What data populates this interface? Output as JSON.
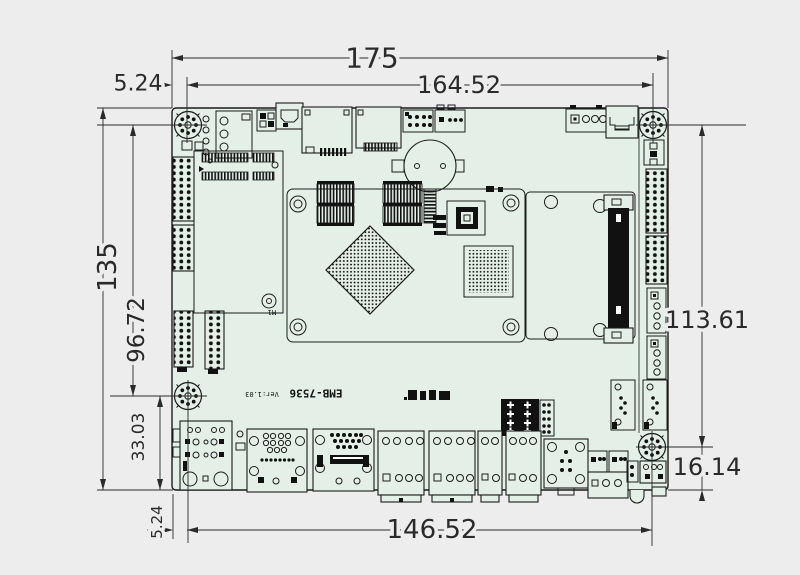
{
  "drawing": {
    "type": "mechanical-dimension-drawing",
    "board": {
      "model": "EMB-7536",
      "version": "Ver:1.03",
      "pcie_hole_label": "M1"
    },
    "dimensions": {
      "top_total_width": "175",
      "top_hole_span": "164.52",
      "top_left_hole_offset": "5.24",
      "left_total_height": "135",
      "left_hole_span": "96.72",
      "left_bottom_hole_offset": "33.03",
      "right_hole_span": "113.61",
      "right_bottom_hole_offset": "16.14",
      "bottom_hole_span": "146.52",
      "bottom_left_hole_offset": "5.24"
    },
    "colors": {
      "background": "#ededed",
      "board_fill": "#e3efe7",
      "line": "#1c1c1c",
      "dimension_text": "#2a2a2a"
    }
  }
}
